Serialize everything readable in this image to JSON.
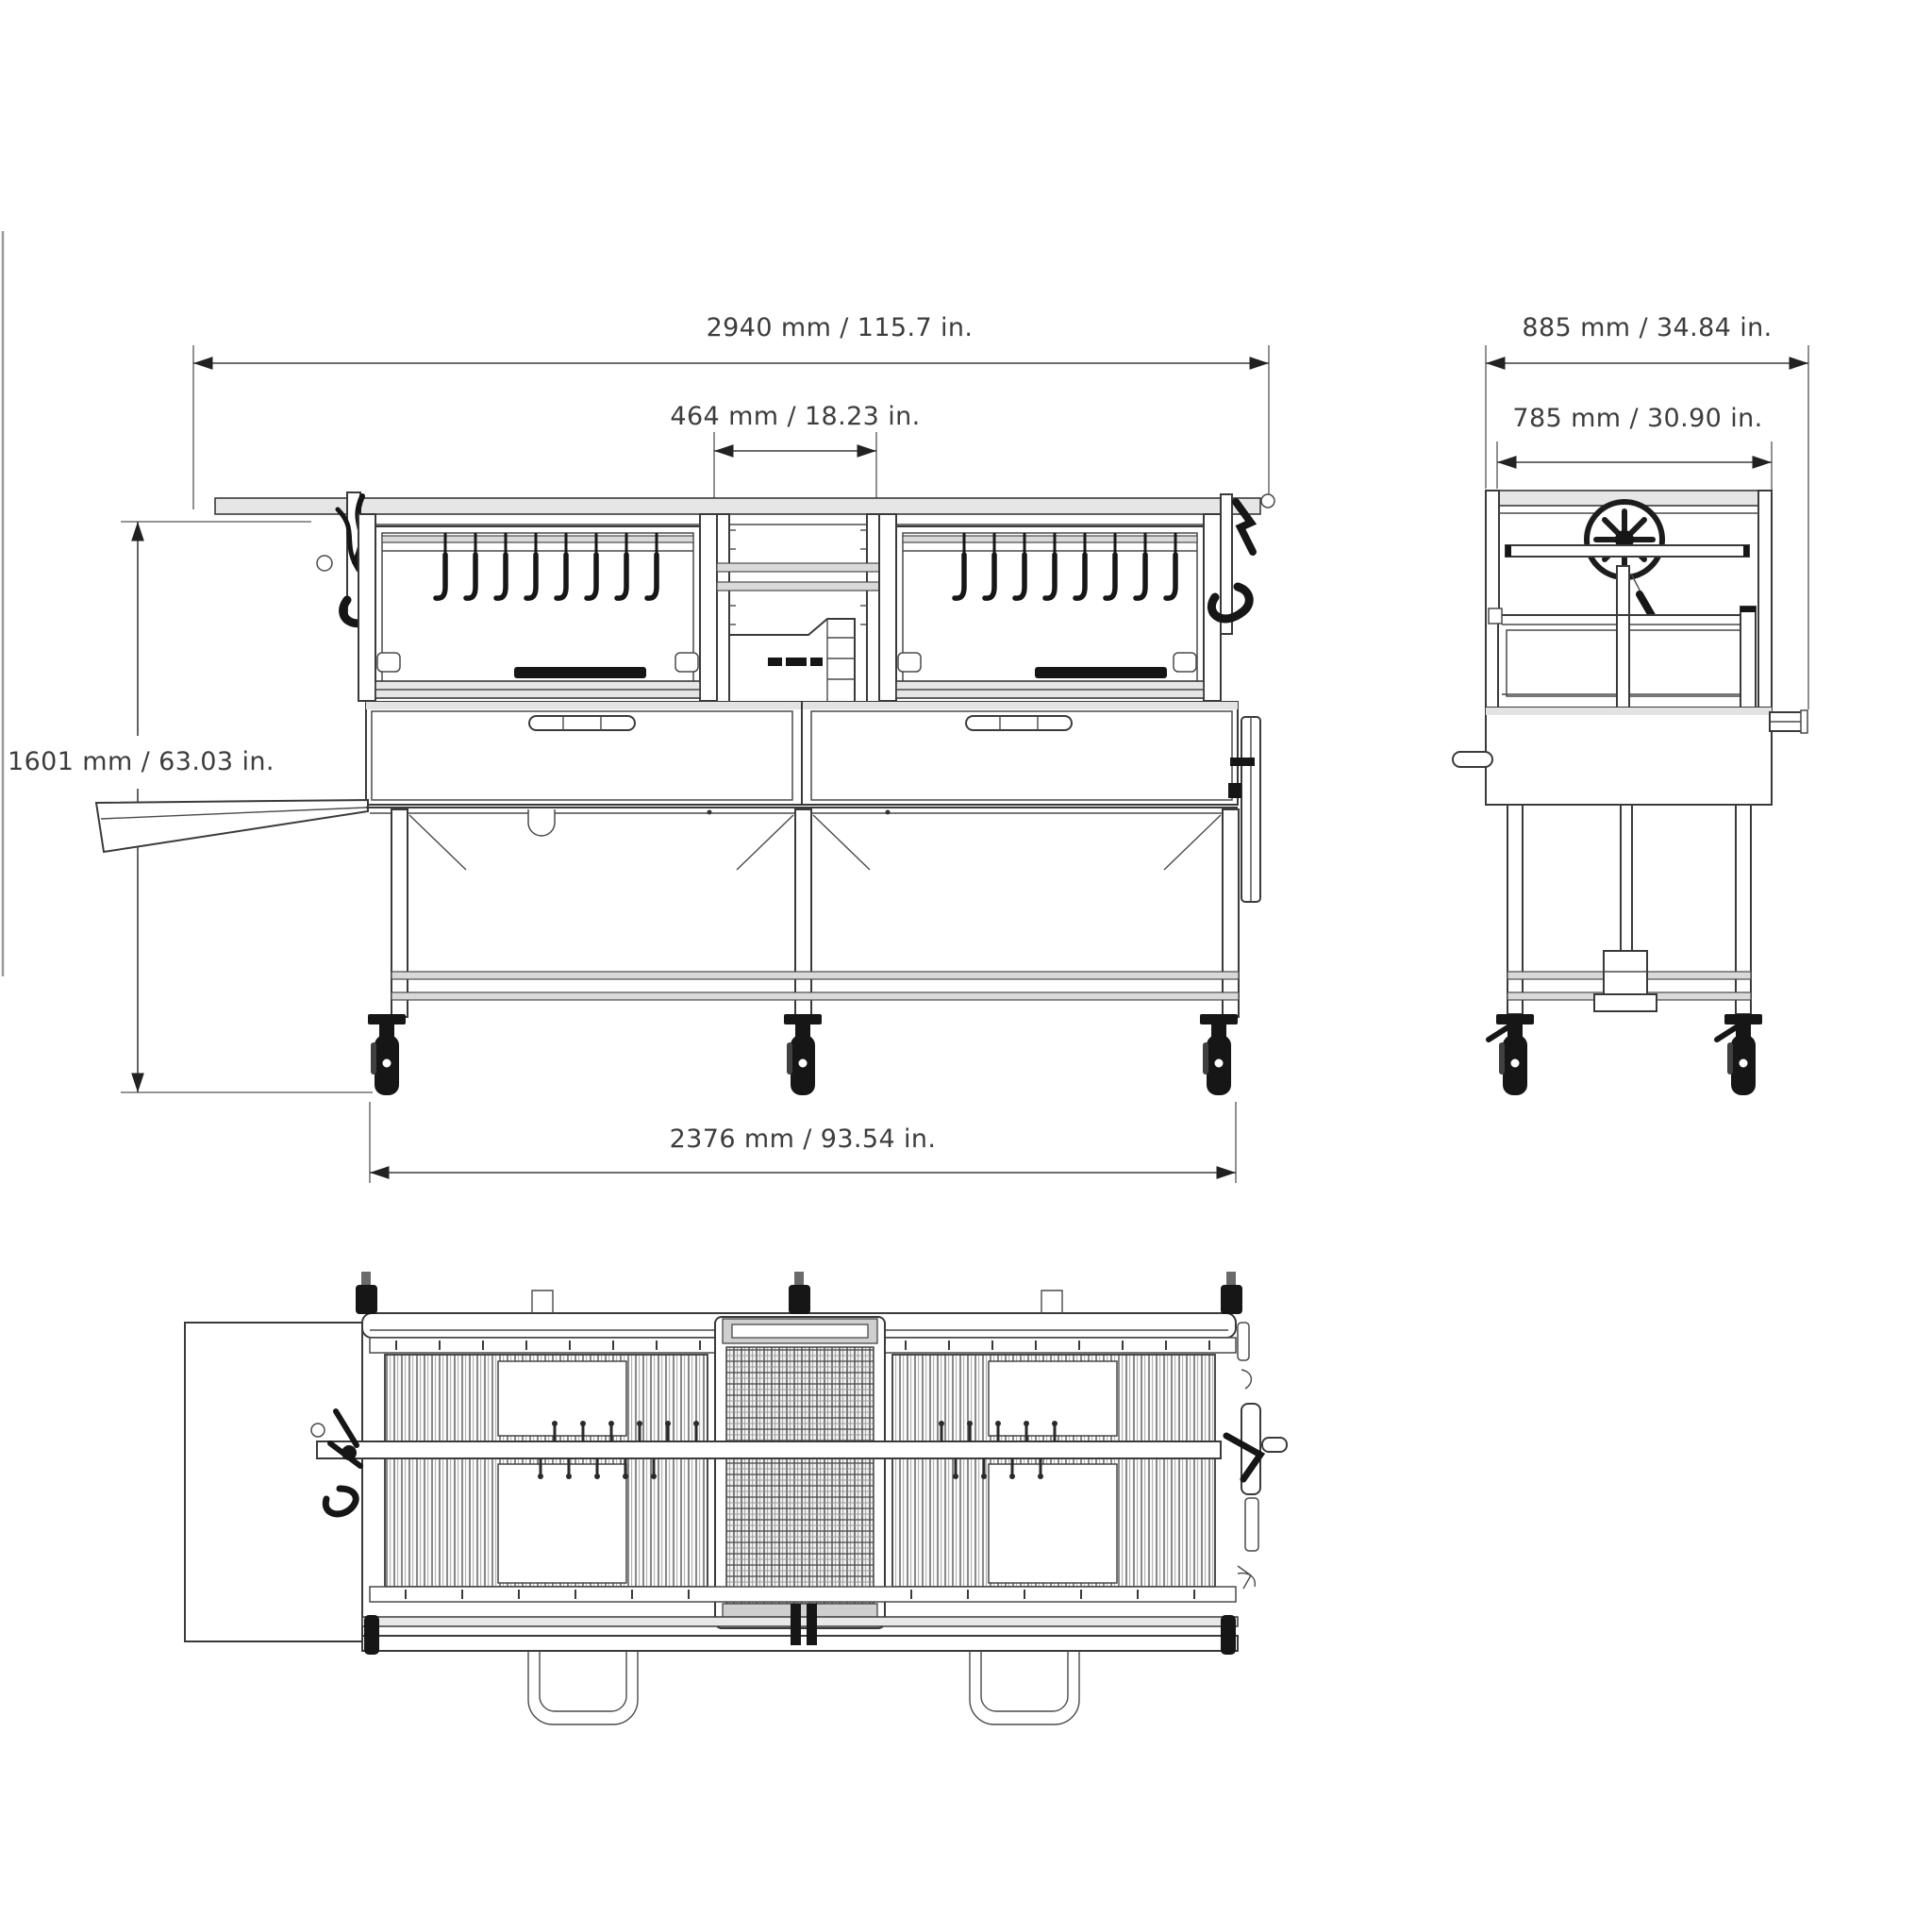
{
  "drawing": {
    "type": "technical-orthographic-views",
    "subject": "argentine-charcoal-grill-cart",
    "background": "#ffffff",
    "line_color": "#3a3a3a",
    "accent_dark": "#161616",
    "front_view": {
      "dim_overall_width": "2940 mm / 115.7 in.",
      "dim_center_width": "464 mm / 18.23 in.",
      "dim_height": "1601 mm / 63.03 in.",
      "dim_base_width": "2376 mm / 93.54 in."
    },
    "side_view": {
      "dim_overall_depth": "885 mm / 34.84 in.",
      "dim_body_depth": "785 mm / 30.90 in."
    }
  }
}
